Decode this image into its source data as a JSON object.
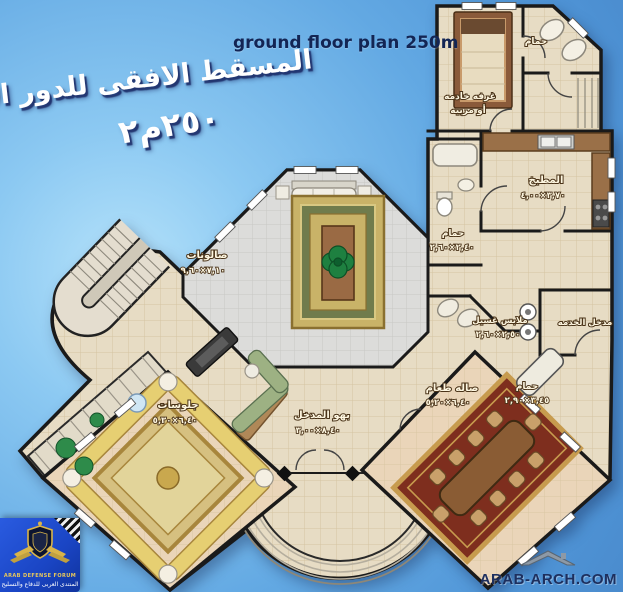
{
  "header": {
    "title_en": "ground floor plan 250m",
    "title_ar": "المسقط الافقى للدور الارضى",
    "area_label": "٢٥٠م٢"
  },
  "rooms": {
    "salons": {
      "label": "صالونات",
      "dims": "٧,١٠×٩,٦٠"
    },
    "sitting": {
      "label": "جلوسات",
      "dims": "٦,٤٠×٥,٣٠"
    },
    "entrance_hall": {
      "label": "بهو المدخل",
      "dims": "٨,٤٠×٣,٠٠"
    },
    "dining": {
      "label": "صاله طعام",
      "dims": "٦,٤٠×٥,٢٠"
    },
    "kitchen": {
      "label": "المطبخ",
      "dims": "٣,٧٠×٤,٠٠"
    },
    "maid_room": {
      "label": "غرفه خادمه",
      "line2": "أو مربيه"
    },
    "maid_bath": {
      "label": "حمام"
    },
    "middle_bath": {
      "label": "حمام",
      "dims": "٢,٤٠×٢,٦٠"
    },
    "laundry": {
      "label": "ملابس غسيل",
      "dims": "٢,٥٠×٢,٦٠"
    },
    "guest_bath": {
      "label": "حمام",
      "dims": "٣,٤٥×٢,٩٠"
    },
    "service_entry": {
      "label": "مدخل الخدمه"
    }
  },
  "footer": {
    "watermark": "ARAB-ARCH.COM",
    "logo_line1": "ARAB DEFENSE FORUM",
    "logo_line2": "المنتدى العربى للدفاع والتسليح"
  },
  "colors": {
    "sky": "#63a9e3",
    "floor_beige": "#ead fc5",
    "floor_gray": "#dddddb",
    "wall": "#1a1a1a",
    "rug_gold": "#c9b368",
    "rug_red": "#7e2e1e",
    "sofa_yellow": "#e6cf72",
    "wood": "#9a6a44",
    "plant_green": "#1e8040",
    "title_blue": "#132554"
  }
}
